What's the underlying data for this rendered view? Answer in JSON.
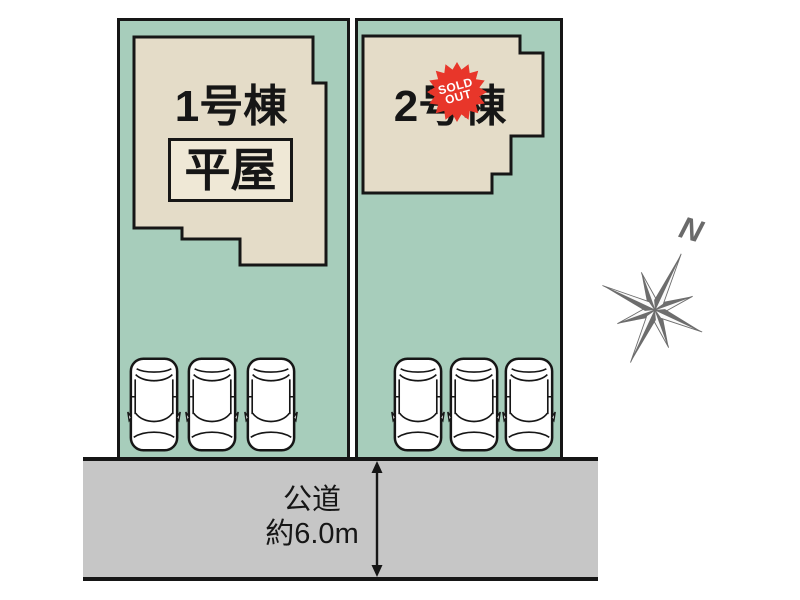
{
  "site_plan": {
    "lot1": {
      "building_label": "1号棟",
      "building_type_label": "平屋",
      "parking_spaces": 3
    },
    "lot2": {
      "building_label": "2号棟",
      "sold_out_badge": {
        "line1": "SOLD",
        "line2": "OUT"
      },
      "parking_spaces": 3
    },
    "road": {
      "label_line1": "公道",
      "label_line2": "約6.0m"
    },
    "compass": {
      "label": "N"
    },
    "colors": {
      "lot_green": "#a7cdbb",
      "building_cream": "#e4dcc8",
      "tag_box_cream": "#efe8d6",
      "road_gray": "#c6c6c6",
      "outline_black": "#161616",
      "sold_badge_red": "#e8362a",
      "compass_gray": "#6a6a6a"
    }
  }
}
